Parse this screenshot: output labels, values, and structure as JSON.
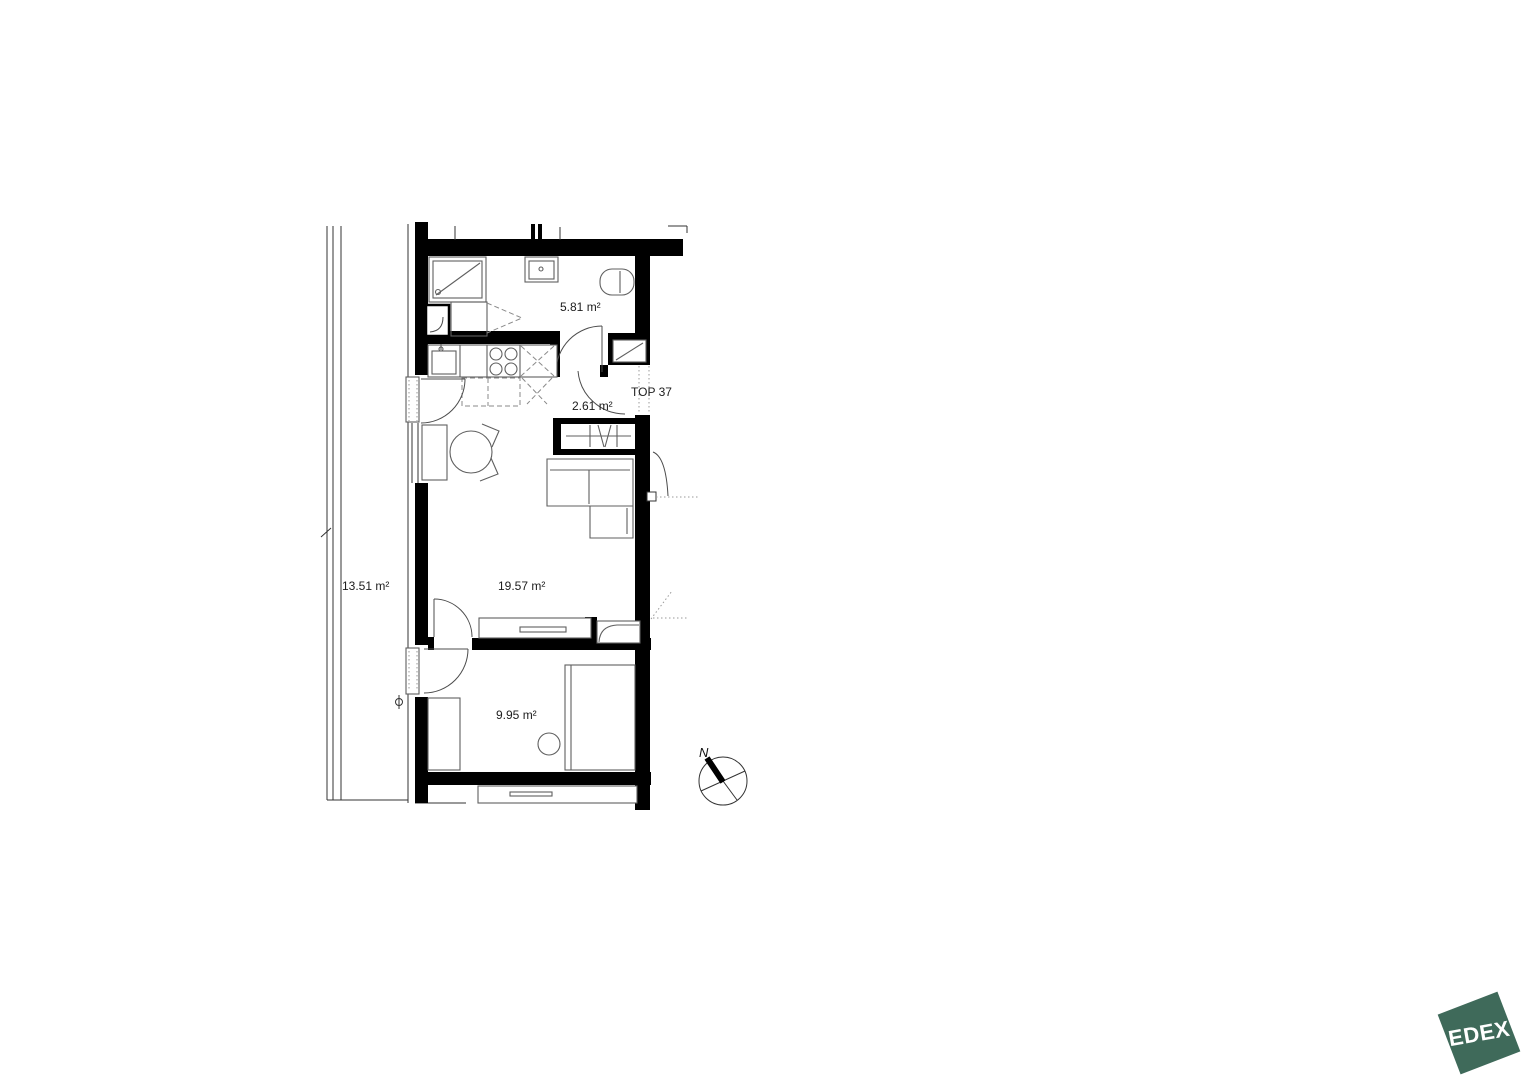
{
  "floorplan": {
    "unit_label": "TOP 37",
    "rooms": [
      {
        "id": "bathroom",
        "area_label": "5.81 m²"
      },
      {
        "id": "entrance_hall",
        "area_label": "2.61 m²"
      },
      {
        "id": "living_room",
        "area_label": "19.57 m²"
      },
      {
        "id": "bedroom",
        "area_label": "9.95 m²"
      },
      {
        "id": "balcony",
        "area_label": "13.51 m²"
      }
    ],
    "compass": {
      "north_label": "N"
    },
    "colors": {
      "wall": "#000000",
      "furniture_line": "#5f5f5f"
    }
  },
  "logo": {
    "text": "EDEX",
    "color": "#3f6a5a"
  }
}
